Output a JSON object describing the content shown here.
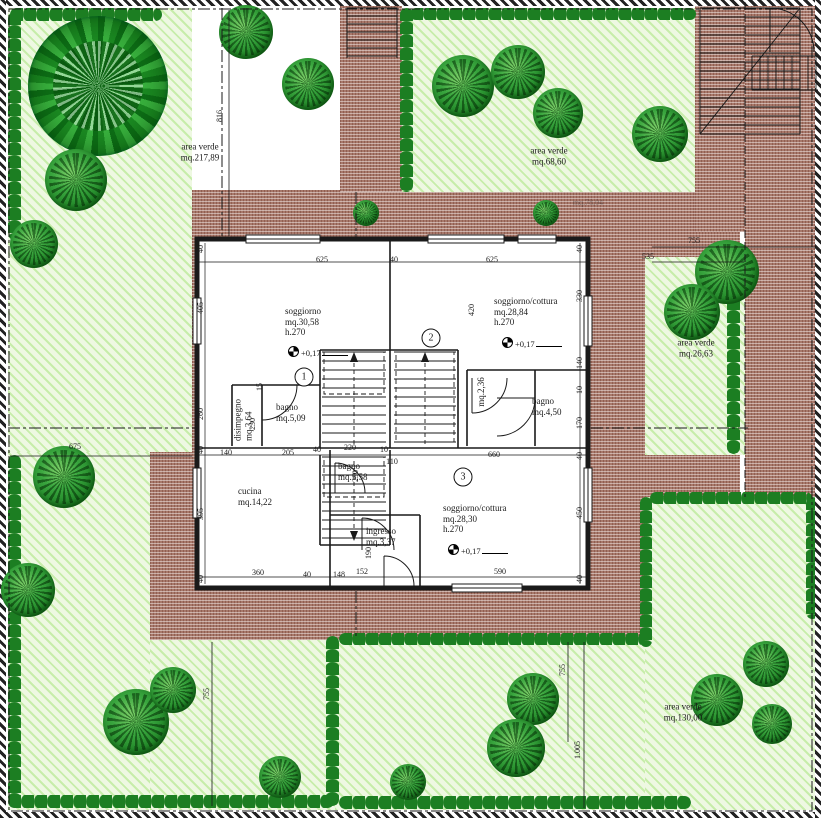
{
  "drawing": {
    "type": "architectural-site-plan",
    "colors": {
      "garden": "#eef8e2",
      "garden_stripe": "#c7edaa",
      "hedge": "#1c7e22",
      "tree": "#2f9e33",
      "paving": "#a8796b",
      "line": "#1a1a1a"
    },
    "area_labels": [
      {
        "lines": [
          "area verde",
          "mq.217,89"
        ],
        "x": 200,
        "y": 152
      },
      {
        "lines": [
          "area verde",
          "mq.68,60"
        ],
        "x": 549,
        "y": 156
      },
      {
        "lines": [
          "area verde",
          "mq.26,63"
        ],
        "x": 696,
        "y": 348
      },
      {
        "lines": [
          "area verde",
          "mq.130,00"
        ],
        "x": 683,
        "y": 712
      }
    ],
    "room_labels": [
      {
        "lines": [
          "soggiorno",
          "mq.30,58",
          "h.270"
        ],
        "x": 285,
        "y": 306
      },
      {
        "lines": [
          "soggiorno/cottura",
          "mq.28,84",
          "h.270"
        ],
        "x": 494,
        "y": 296
      },
      {
        "lines": [
          "bagno",
          "mq.5,09"
        ],
        "x": 276,
        "y": 402
      },
      {
        "lines": [
          "disimpegno",
          "mq.3,64"
        ],
        "x": 243,
        "y": 420,
        "r": -90
      },
      {
        "lines": [
          "bagno",
          "mq.4,50"
        ],
        "x": 532,
        "y": 396
      },
      {
        "lines": [
          "mq.2,36"
        ],
        "x": 481,
        "y": 392,
        "r": -90
      },
      {
        "lines": [
          "cucina",
          "mq.14,22"
        ],
        "x": 238,
        "y": 486
      },
      {
        "lines": [
          "bagno",
          "mq.5,58"
        ],
        "x": 338,
        "y": 461
      },
      {
        "lines": [
          "ingresso",
          "mq.3,37"
        ],
        "x": 366,
        "y": 526
      },
      {
        "lines": [
          "soggiorno/cottura",
          "mq.28,30",
          "h.270"
        ],
        "x": 443,
        "y": 503
      }
    ],
    "unit_numbers": [
      {
        "n": "1",
        "x": 304,
        "y": 377
      },
      {
        "n": "2",
        "x": 431,
        "y": 338
      },
      {
        "n": "3",
        "x": 463,
        "y": 477
      }
    ],
    "level_markers": [
      {
        "t": "+0,17",
        "x": 288,
        "y": 352
      },
      {
        "t": "+0,17",
        "x": 502,
        "y": 343
      },
      {
        "t": "+0,17",
        "x": 448,
        "y": 550
      }
    ],
    "dimensions": [
      {
        "t": "625",
        "x": 322,
        "y": 260
      },
      {
        "t": "40",
        "x": 394,
        "y": 260
      },
      {
        "t": "625",
        "x": 492,
        "y": 260
      },
      {
        "t": "40",
        "x": 201,
        "y": 249,
        "r": -90
      },
      {
        "t": "40",
        "x": 580,
        "y": 249,
        "r": -90
      },
      {
        "t": "405",
        "x": 201,
        "y": 308,
        "r": -90
      },
      {
        "t": "260",
        "x": 201,
        "y": 414,
        "r": -90
      },
      {
        "t": "40",
        "x": 201,
        "y": 450,
        "r": -90
      },
      {
        "t": "395",
        "x": 201,
        "y": 514,
        "r": -90
      },
      {
        "t": "40",
        "x": 201,
        "y": 579,
        "r": -90
      },
      {
        "t": "330",
        "x": 580,
        "y": 296,
        "r": -90
      },
      {
        "t": "140",
        "x": 580,
        "y": 363,
        "r": -90
      },
      {
        "t": "10",
        "x": 580,
        "y": 390,
        "r": -90
      },
      {
        "t": "170",
        "x": 580,
        "y": 423,
        "r": -90
      },
      {
        "t": "40",
        "x": 580,
        "y": 456,
        "r": -90
      },
      {
        "t": "450",
        "x": 580,
        "y": 513,
        "r": -90
      },
      {
        "t": "40",
        "x": 580,
        "y": 579,
        "r": -90
      },
      {
        "t": "420",
        "x": 472,
        "y": 310,
        "r": -90
      },
      {
        "t": "230",
        "x": 253,
        "y": 424,
        "r": -90
      },
      {
        "t": "15",
        "x": 260,
        "y": 387,
        "r": -90
      },
      {
        "t": "140",
        "x": 226,
        "y": 453
      },
      {
        "t": "205",
        "x": 288,
        "y": 453
      },
      {
        "t": "40",
        "x": 317,
        "y": 450
      },
      {
        "t": "220",
        "x": 350,
        "y": 448
      },
      {
        "t": "10",
        "x": 384,
        "y": 450
      },
      {
        "t": "660",
        "x": 494,
        "y": 455
      },
      {
        "t": "110",
        "x": 392,
        "y": 462
      },
      {
        "t": "360",
        "x": 258,
        "y": 573
      },
      {
        "t": "40",
        "x": 307,
        "y": 575
      },
      {
        "t": "148",
        "x": 339,
        "y": 575
      },
      {
        "t": "152",
        "x": 362,
        "y": 572
      },
      {
        "t": "590",
        "x": 500,
        "y": 572
      },
      {
        "t": "190",
        "x": 369,
        "y": 553,
        "r": -90
      },
      {
        "t": "230",
        "x": 356,
        "y": 476,
        "r": -90
      },
      {
        "t": "816",
        "x": 220,
        "y": 116,
        "r": -90
      },
      {
        "t": "755",
        "x": 694,
        "y": 241
      },
      {
        "t": "535",
        "x": 648,
        "y": 257
      },
      {
        "t": "675",
        "x": 75,
        "y": 447
      },
      {
        "t": "755",
        "x": 207,
        "y": 694,
        "r": -90
      },
      {
        "t": "755",
        "x": 563,
        "y": 670,
        "r": -90
      },
      {
        "t": "1.005",
        "x": 578,
        "y": 750,
        "r": -90
      },
      {
        "t": "mq.78,04",
        "x": 588,
        "y": 203,
        "cls": "faint"
      }
    ],
    "trees": [
      {
        "x": 98,
        "y": 86,
        "d": 140,
        "burst": true
      },
      {
        "x": 76,
        "y": 180,
        "d": 62
      },
      {
        "x": 34,
        "y": 244,
        "d": 48
      },
      {
        "x": 246,
        "y": 32,
        "d": 54
      },
      {
        "x": 308,
        "y": 84,
        "d": 52
      },
      {
        "x": 463,
        "y": 86,
        "d": 62
      },
      {
        "x": 518,
        "y": 72,
        "d": 54
      },
      {
        "x": 558,
        "y": 113,
        "d": 50
      },
      {
        "x": 660,
        "y": 134,
        "d": 56
      },
      {
        "x": 727,
        "y": 272,
        "d": 64
      },
      {
        "x": 692,
        "y": 312,
        "d": 56
      },
      {
        "x": 64,
        "y": 477,
        "d": 62
      },
      {
        "x": 28,
        "y": 590,
        "d": 54
      },
      {
        "x": 136,
        "y": 722,
        "d": 66
      },
      {
        "x": 173,
        "y": 690,
        "d": 46
      },
      {
        "x": 280,
        "y": 777,
        "d": 42
      },
      {
        "x": 533,
        "y": 699,
        "d": 52
      },
      {
        "x": 516,
        "y": 748,
        "d": 58
      },
      {
        "x": 408,
        "y": 782,
        "d": 36
      },
      {
        "x": 717,
        "y": 700,
        "d": 52
      },
      {
        "x": 766,
        "y": 664,
        "d": 46
      },
      {
        "x": 772,
        "y": 724,
        "d": 40
      },
      {
        "x": 366,
        "y": 213,
        "d": 26
      },
      {
        "x": 546,
        "y": 213,
        "d": 26
      }
    ]
  }
}
